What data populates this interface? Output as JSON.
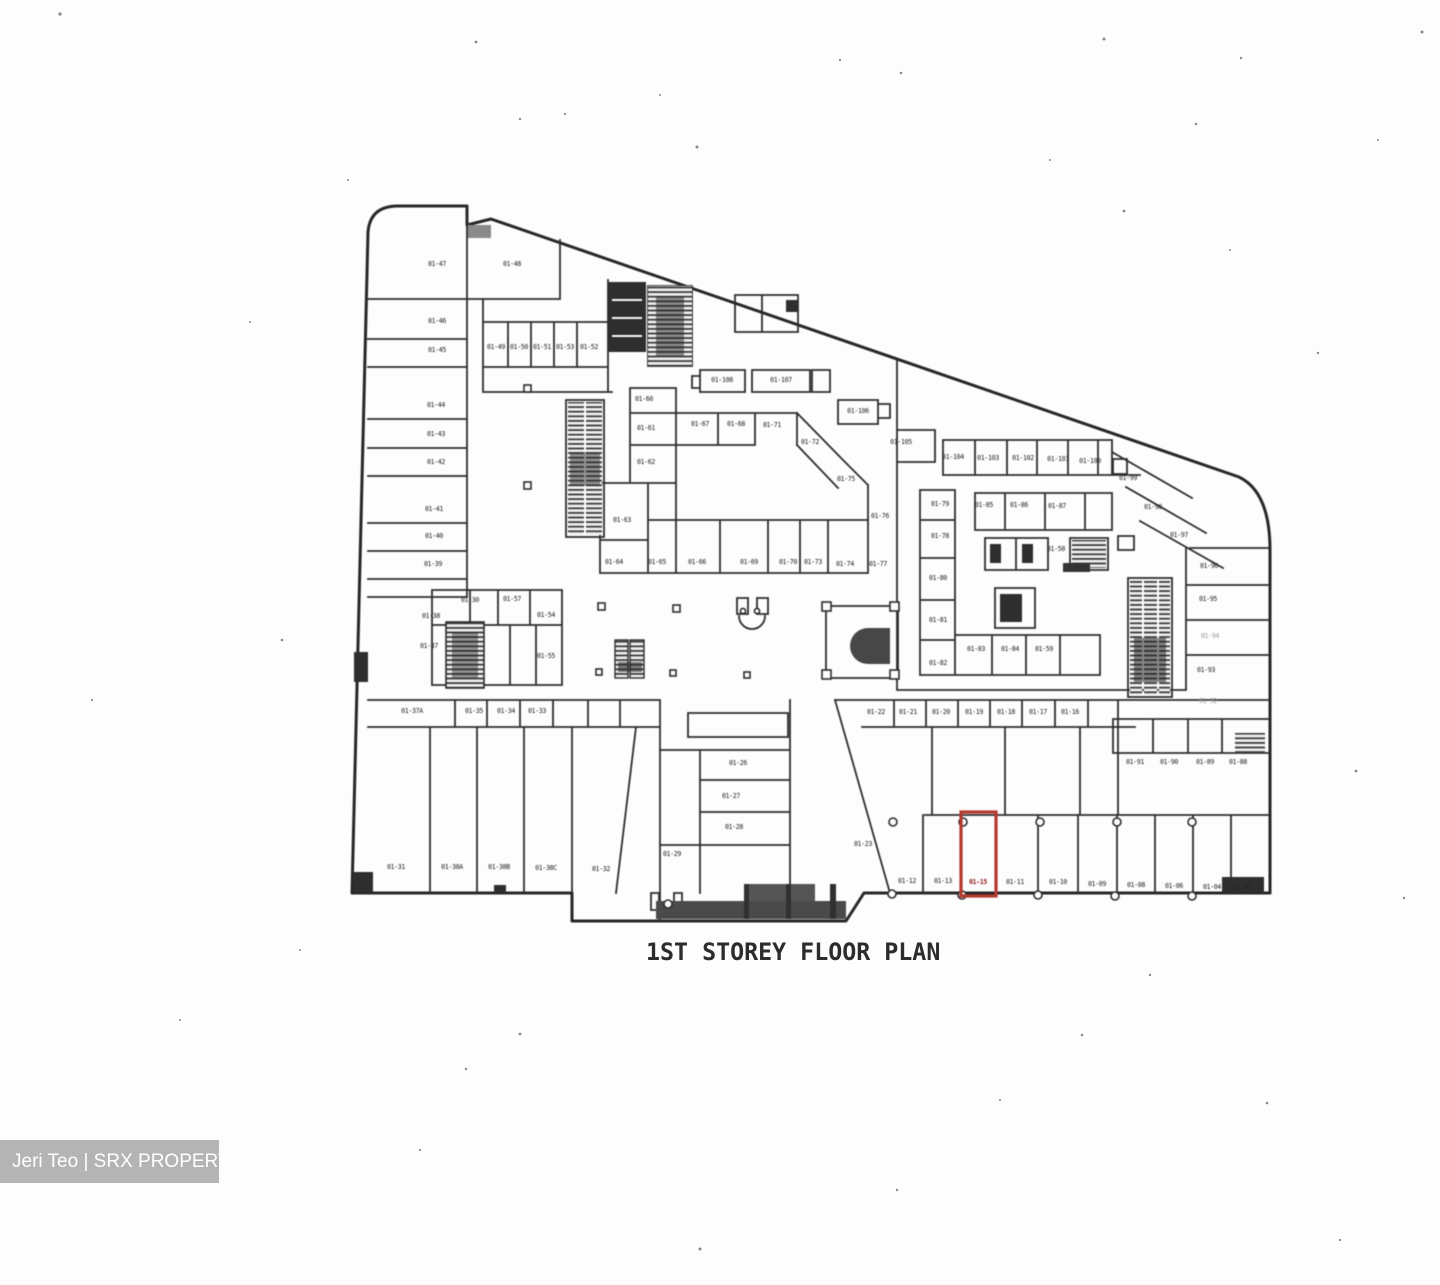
{
  "title": "1ST STOREY FLOOR PLAN",
  "watermark": {
    "text": "Jeri Teo | SRX PROPERTY"
  },
  "plan": {
    "ink_color": "#2d2d2d",
    "highlight_color": "#b5382c",
    "highlighted_unit": {
      "id": "01-15",
      "x": 961,
      "y": 812,
      "w": 35,
      "h": 84,
      "label_x": 978,
      "label_y": 884
    },
    "units": [
      {
        "id": "01-47",
        "x": 437,
        "y": 266
      },
      {
        "id": "01-46",
        "x": 437,
        "y": 323
      },
      {
        "id": "01-45",
        "x": 437,
        "y": 352
      },
      {
        "id": "01-44",
        "x": 436,
        "y": 407
      },
      {
        "id": "01-43",
        "x": 436,
        "y": 436
      },
      {
        "id": "01-42",
        "x": 436,
        "y": 464
      },
      {
        "id": "01-41",
        "x": 434,
        "y": 511
      },
      {
        "id": "01-40",
        "x": 434,
        "y": 538
      },
      {
        "id": "01-39",
        "x": 433,
        "y": 566
      },
      {
        "id": "01-38",
        "x": 431,
        "y": 618
      },
      {
        "id": "01-37",
        "x": 429,
        "y": 648
      },
      {
        "id": "01-48",
        "x": 512,
        "y": 266
      },
      {
        "id": "01-49",
        "x": 496,
        "y": 349
      },
      {
        "id": "01-50",
        "x": 519,
        "y": 349
      },
      {
        "id": "01-51",
        "x": 542,
        "y": 349
      },
      {
        "id": "01-53",
        "x": 565,
        "y": 349
      },
      {
        "id": "01-52",
        "x": 589,
        "y": 349
      },
      {
        "id": "01-30",
        "x": 470,
        "y": 602
      },
      {
        "id": "01-57",
        "x": 512,
        "y": 601
      },
      {
        "id": "01-54",
        "x": 546,
        "y": 617
      },
      {
        "id": "01-55",
        "x": 546,
        "y": 658
      },
      {
        "id": "01-108",
        "x": 722,
        "y": 382
      },
      {
        "id": "01-107",
        "x": 781,
        "y": 382
      },
      {
        "id": "01-106",
        "x": 858,
        "y": 413
      },
      {
        "id": "01-105",
        "x": 901,
        "y": 444
      },
      {
        "id": "01-60",
        "x": 644,
        "y": 401
      },
      {
        "id": "01-61",
        "x": 646,
        "y": 430
      },
      {
        "id": "01-62",
        "x": 646,
        "y": 464
      },
      {
        "id": "01-67",
        "x": 700,
        "y": 426
      },
      {
        "id": "01-68",
        "x": 736,
        "y": 426
      },
      {
        "id": "01-71",
        "x": 772,
        "y": 427
      },
      {
        "id": "01-72",
        "x": 810,
        "y": 444
      },
      {
        "id": "01-75",
        "x": 846,
        "y": 481
      },
      {
        "id": "01-76",
        "x": 880,
        "y": 518
      },
      {
        "id": "01-63",
        "x": 622,
        "y": 522
      },
      {
        "id": "01-64",
        "x": 614,
        "y": 564
      },
      {
        "id": "01-65",
        "x": 657,
        "y": 564
      },
      {
        "id": "01-66",
        "x": 697,
        "y": 564
      },
      {
        "id": "01-69",
        "x": 749,
        "y": 564
      },
      {
        "id": "01-70",
        "x": 788,
        "y": 564
      },
      {
        "id": "01-73",
        "x": 813,
        "y": 564
      },
      {
        "id": "01-74",
        "x": 845,
        "y": 566
      },
      {
        "id": "01-77",
        "x": 878,
        "y": 566
      },
      {
        "id": "01-104",
        "x": 953,
        "y": 459
      },
      {
        "id": "01-103",
        "x": 988,
        "y": 460
      },
      {
        "id": "01-102",
        "x": 1023,
        "y": 460
      },
      {
        "id": "01-101",
        "x": 1058,
        "y": 461
      },
      {
        "id": "01-100",
        "x": 1090,
        "y": 463
      },
      {
        "id": "01-99",
        "x": 1128,
        "y": 480
      },
      {
        "id": "01-98",
        "x": 1153,
        "y": 509
      },
      {
        "id": "01-97",
        "x": 1179,
        "y": 537
      },
      {
        "id": "01-79",
        "x": 940,
        "y": 506
      },
      {
        "id": "01-78",
        "x": 940,
        "y": 538
      },
      {
        "id": "01-80",
        "x": 938,
        "y": 580
      },
      {
        "id": "01-81",
        "x": 938,
        "y": 622
      },
      {
        "id": "01-82",
        "x": 938,
        "y": 665
      },
      {
        "id": "01-85",
        "x": 984,
        "y": 507
      },
      {
        "id": "01-86",
        "x": 1019,
        "y": 507
      },
      {
        "id": "01-87",
        "x": 1057,
        "y": 508
      },
      {
        "id": "01-58",
        "x": 1056,
        "y": 551
      },
      {
        "id": "01-83",
        "x": 976,
        "y": 651
      },
      {
        "id": "01-84",
        "x": 1010,
        "y": 651
      },
      {
        "id": "01-59",
        "x": 1044,
        "y": 651
      },
      {
        "id": "01-96",
        "x": 1209,
        "y": 568
      },
      {
        "id": "01-95",
        "x": 1208,
        "y": 601
      },
      {
        "id": "01-94",
        "x": 1210,
        "y": 638,
        "faint": true
      },
      {
        "id": "01-93",
        "x": 1206,
        "y": 672
      },
      {
        "id": "01-92",
        "x": 1208,
        "y": 703,
        "faint": true
      },
      {
        "id": "01-91",
        "x": 1135,
        "y": 764
      },
      {
        "id": "01-90",
        "x": 1169,
        "y": 764
      },
      {
        "id": "01-89",
        "x": 1205,
        "y": 764
      },
      {
        "id": "01-88",
        "x": 1238,
        "y": 764
      },
      {
        "id": "01-22",
        "x": 876,
        "y": 714
      },
      {
        "id": "01-21",
        "x": 908,
        "y": 714
      },
      {
        "id": "01-20",
        "x": 941,
        "y": 714
      },
      {
        "id": "01-19",
        "x": 974,
        "y": 714
      },
      {
        "id": "01-18",
        "x": 1006,
        "y": 714
      },
      {
        "id": "01-17",
        "x": 1038,
        "y": 714
      },
      {
        "id": "01-16",
        "x": 1070,
        "y": 714
      },
      {
        "id": "01-37A",
        "x": 412,
        "y": 713
      },
      {
        "id": "01-35",
        "x": 474,
        "y": 713
      },
      {
        "id": "01-34",
        "x": 506,
        "y": 713
      },
      {
        "id": "01-33",
        "x": 537,
        "y": 713
      },
      {
        "id": "01-31",
        "x": 396,
        "y": 869
      },
      {
        "id": "01-38A",
        "x": 452,
        "y": 869
      },
      {
        "id": "01-38B",
        "x": 499,
        "y": 869
      },
      {
        "id": "01-38C",
        "x": 546,
        "y": 870
      },
      {
        "id": "01-32",
        "x": 601,
        "y": 871
      },
      {
        "id": "01-26",
        "x": 738,
        "y": 765
      },
      {
        "id": "01-27",
        "x": 731,
        "y": 798
      },
      {
        "id": "01-28",
        "x": 734,
        "y": 829
      },
      {
        "id": "01-29",
        "x": 672,
        "y": 856
      },
      {
        "id": "01-23",
        "x": 863,
        "y": 846
      },
      {
        "id": "01-12",
        "x": 907,
        "y": 883
      },
      {
        "id": "01-13",
        "x": 943,
        "y": 883
      },
      {
        "id": "01-11",
        "x": 1015,
        "y": 884
      },
      {
        "id": "01-10",
        "x": 1058,
        "y": 884
      },
      {
        "id": "01-09",
        "x": 1097,
        "y": 886
      },
      {
        "id": "01-08",
        "x": 1136,
        "y": 887
      },
      {
        "id": "01-06",
        "x": 1174,
        "y": 888
      },
      {
        "id": "01-04",
        "x": 1212,
        "y": 889
      },
      {
        "id": "01-02",
        "x": 1242,
        "y": 890
      }
    ]
  }
}
